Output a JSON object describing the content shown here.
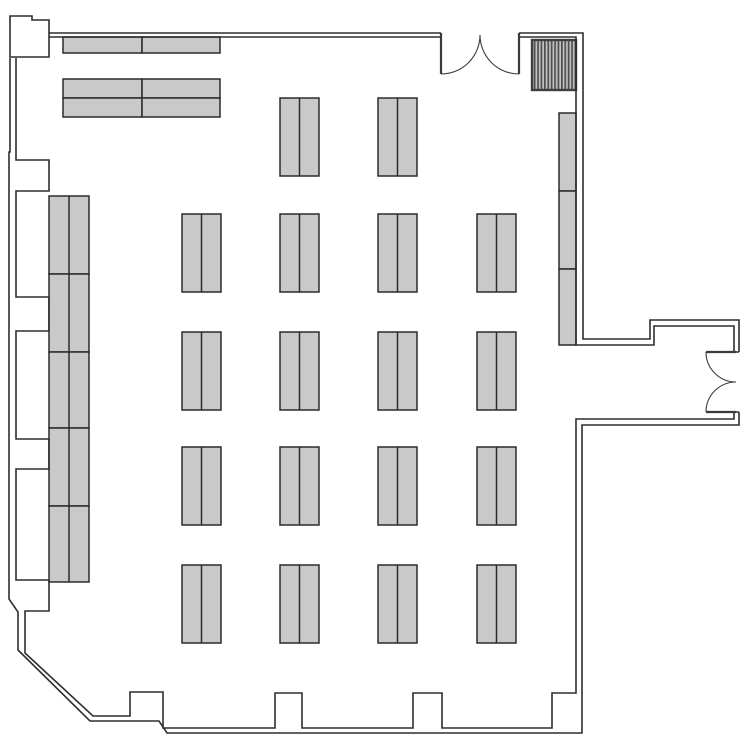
{
  "page": {
    "background": "#ffffff"
  },
  "colors": {
    "background": "#ffffff",
    "wall_line": "#2e2e2e",
    "door_line": "#3a3a3a",
    "table_fill": "#c9c9c9",
    "table_stroke": "#2b2b2b",
    "hatch_border": "#3f3f3f",
    "hatch_dark": "#4f4f4f",
    "hatch_light": "#c2c2c2"
  },
  "plan": {
    "canvas": {
      "w": 750,
      "h": 750
    },
    "walls": {
      "outer": "M49,33 H441 M519,33 H583 V339 H650 V320 H739 V352 M739,412 V425 H582 V733 H167 L159,721 H90 L18,650 V612 L9,599 V152 H10 V58",
      "inner": "M49,37 H441 M519,37 H576 V345 H654 V326 H734 V352 M734,412 V419 H576 V693 H552 V728 H442 V693 H413 V728 H302 V693 H275 V728 H163 V692 H130 V716 H93 L25,653 V611 H49 V580 H16 V469 H49 V439 H16 V331 H49 V297 H16 V191 H49 V160 H16 V58",
      "corner_block": "M10,57 V16 H32 V20 H49 V57 Z",
      "end_caps": "M441,33 V37 M519,33 V37 M734,352 H739 M734,412 H739"
    },
    "doors": [
      {
        "id": "double-door-top",
        "leaves": "M441,33 V74 M519,33 V74",
        "arcs": "M441,74 A39,39 0 0 0 480,35 M519,74 A39,39 0 0 1 480,35"
      },
      {
        "id": "double-door-right",
        "leaves": "M736,352 H706 M736,412 H706",
        "arcs": "M706,352 A30,30 0 0 0 736,382 M706,412 A30,30 0 0 1 736,382"
      }
    ],
    "stairs_hatch": {
      "x": 532,
      "y": 40,
      "w": 44,
      "h": 50,
      "stripe_pitch": 3.4,
      "stripe_width": 1.7
    },
    "tables": {
      "stroke_width": 1.5,
      "groups": [
        {
          "id": "tables-top-wall",
          "split": "none",
          "rects": [
            [
              63,
              37,
              79,
              16
            ],
            [
              142,
              37,
              78,
              16
            ],
            [
              63,
              79,
              79,
              19
            ],
            [
              142,
              79,
              78,
              19
            ],
            [
              63,
              98,
              79,
              19
            ],
            [
              142,
              98,
              78,
              19
            ]
          ]
        },
        {
          "id": "tables-left-wall",
          "split": "v",
          "rects": [
            [
              49,
              196,
              40,
              78
            ],
            [
              49,
              274,
              40,
              78
            ],
            [
              49,
              352,
              40,
              76
            ],
            [
              49,
              428,
              40,
              78
            ],
            [
              49,
              506,
              40,
              76
            ]
          ]
        },
        {
          "id": "tables-right-wall",
          "split": "none",
          "rects": [
            [
              559,
              113,
              17,
              78
            ],
            [
              559,
              191,
              17,
              78
            ],
            [
              559,
              269,
              17,
              76
            ]
          ]
        },
        {
          "id": "tables-middle",
          "split": "v",
          "rects": [
            [
              280,
              98,
              39,
              78
            ],
            [
              378,
              98,
              39,
              78
            ],
            [
              182,
              214,
              39,
              78
            ],
            [
              280,
              214,
              39,
              78
            ],
            [
              378,
              214,
              39,
              78
            ],
            [
              477,
              214,
              39,
              78
            ],
            [
              182,
              332,
              39,
              78
            ],
            [
              280,
              332,
              39,
              78
            ],
            [
              378,
              332,
              39,
              78
            ],
            [
              477,
              332,
              39,
              78
            ],
            [
              182,
              447,
              39,
              78
            ],
            [
              280,
              447,
              39,
              78
            ],
            [
              378,
              447,
              39,
              78
            ],
            [
              477,
              447,
              39,
              78
            ],
            [
              182,
              565,
              39,
              78
            ],
            [
              280,
              565,
              39,
              78
            ],
            [
              378,
              565,
              39,
              78
            ],
            [
              477,
              565,
              39,
              78
            ]
          ]
        }
      ]
    }
  }
}
